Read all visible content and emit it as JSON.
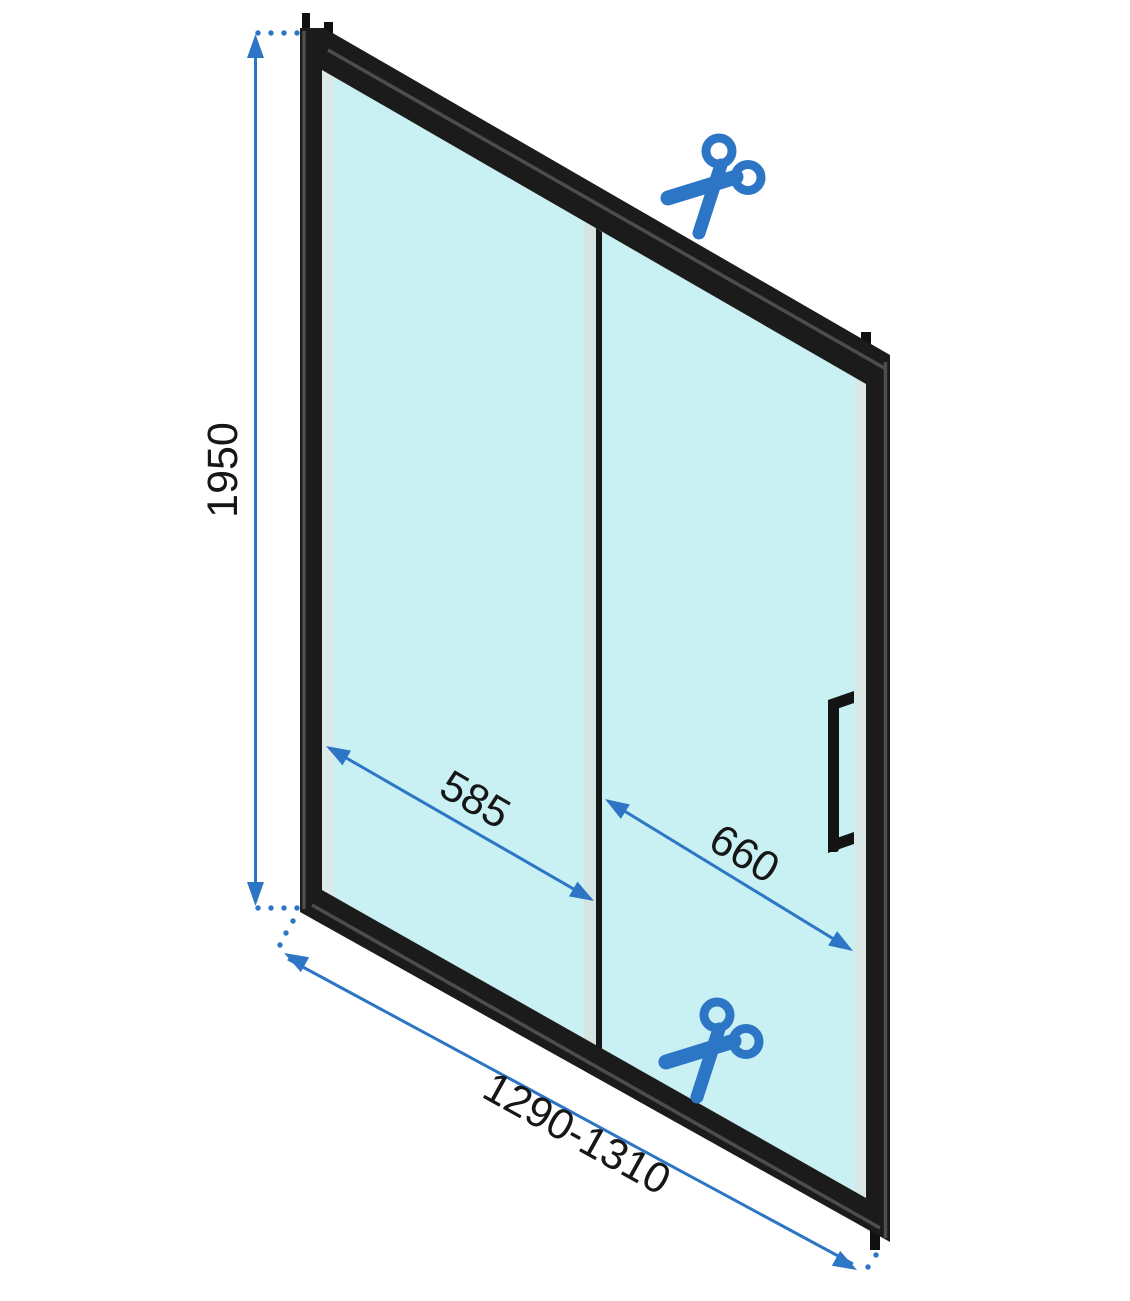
{
  "diagram": {
    "dimensions": {
      "height": "1950",
      "fixed_panel_width": "585",
      "door_panel_width": "660",
      "total_width_range": "1290-1310"
    },
    "icons": {
      "top": "scissors-icon",
      "bottom": "scissors-icon"
    },
    "colors": {
      "accent_blue": "#2c76c5",
      "frame_black": "#1b1b1b",
      "glass_fill": "#c9f0f3",
      "glass_edge": "#dcebe8",
      "divider": "#161616",
      "background": "#ffffff"
    }
  }
}
